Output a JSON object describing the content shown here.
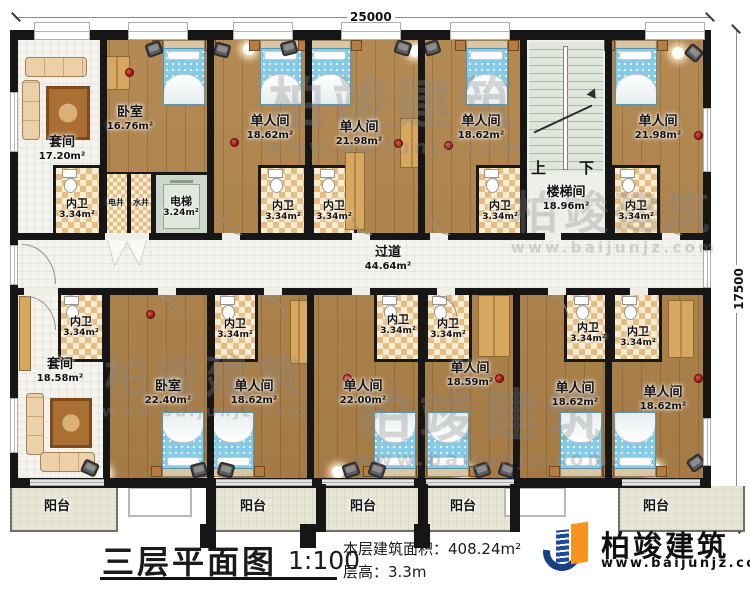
{
  "dimensions": {
    "top_width": "25000",
    "right_height": "17500"
  },
  "rooms": {
    "suiteTop": {
      "name": "套间",
      "area": "17.20m²"
    },
    "bedroomTop": {
      "name": "卧室",
      "area": "16.76m²"
    },
    "singleTopA": {
      "name": "单人间",
      "area": "18.62m²"
    },
    "singleTopB": {
      "name": "单人间",
      "area": "21.98m²"
    },
    "singleTopC": {
      "name": "单人间",
      "area": "18.62m²"
    },
    "singleTopD": {
      "name": "单人间",
      "area": "21.98m²"
    },
    "stairwell": {
      "name": "楼梯间",
      "area": "18.96m²"
    },
    "corridor": {
      "name": "过道",
      "area": "44.64m²"
    },
    "elevator": {
      "name": "电梯",
      "area": "3.24m²"
    },
    "electricShaft": {
      "name": "电井"
    },
    "waterShaft": {
      "name": "水井"
    },
    "innerBath": {
      "name": "内卫",
      "area": "3.34m²"
    },
    "suiteBottom": {
      "name": "套间",
      "area": "18.58m²"
    },
    "bedroomBottom": {
      "name": "卧室",
      "area": "22.40m²"
    },
    "singleBotA": {
      "name": "单人间",
      "area": "18.62m²"
    },
    "singleBotB": {
      "name": "单人间",
      "area": "22.00m²"
    },
    "singleBotC": {
      "name": "单人间",
      "area": "18.59m²"
    },
    "singleBotD": {
      "name": "单人间",
      "area": "18.62m²"
    },
    "singleBotE": {
      "name": "单人间",
      "area": "18.62m²"
    },
    "balcony": {
      "name": "阳台"
    }
  },
  "stairs": {
    "up": "上",
    "down": "下"
  },
  "title_block": {
    "title": "三层平面图",
    "scale": "1:100",
    "area": "本层建筑面积：408.24m²",
    "floor_height": "层高：3.3m"
  },
  "brand": {
    "name": "柏竣建筑",
    "website": "www.baijunjz.com"
  },
  "watermark": {
    "name": "柏竣建筑",
    "website": "www.baijunjz.com"
  },
  "colors": {
    "wall": "#161616",
    "wood_floor": "#b0834a",
    "bath_tile": "#e5bd83",
    "bed": "#85cbe8",
    "brand_blue": "#1c4b9b",
    "brand_orange": "#f7941d"
  }
}
